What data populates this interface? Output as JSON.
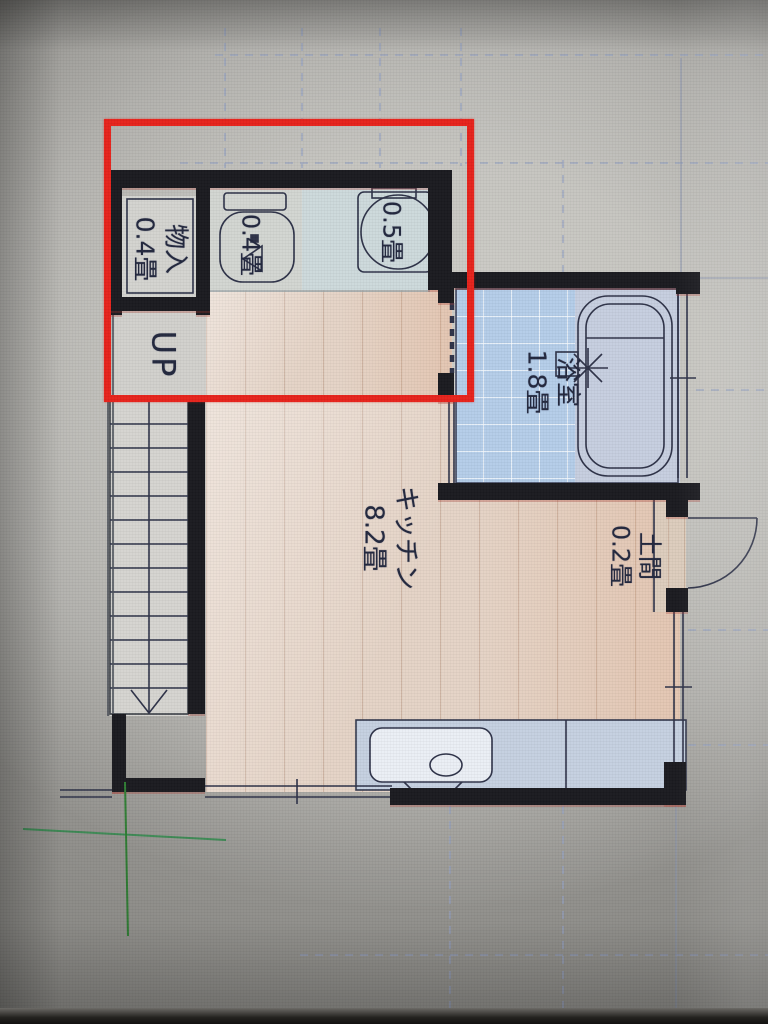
{
  "annotation": {
    "highlight_box_color": "#e6231c",
    "crosshair_color": "#377f42"
  },
  "rooms": {
    "storage": {
      "name": "物入",
      "area": "0.4畳"
    },
    "toilet": {
      "area": "0.4畳"
    },
    "washbasin": {
      "area": "0.5畳"
    },
    "stairs": {
      "direction_label": "UP"
    },
    "bathroom": {
      "name": "浴室",
      "area": "1.8畳"
    },
    "kitchen": {
      "name": "キッチン",
      "area": "8.2畳"
    },
    "entry": {
      "name": "土間",
      "area": "0.2畳"
    }
  },
  "colors": {
    "wall": "#1b1b20",
    "tile_blue": "#b4cde8",
    "wood_floor": "#e4d3c6",
    "counter_blue": "#c5d0e0",
    "grid_line": "#93a0c0",
    "label_ink": "#23283e"
  }
}
